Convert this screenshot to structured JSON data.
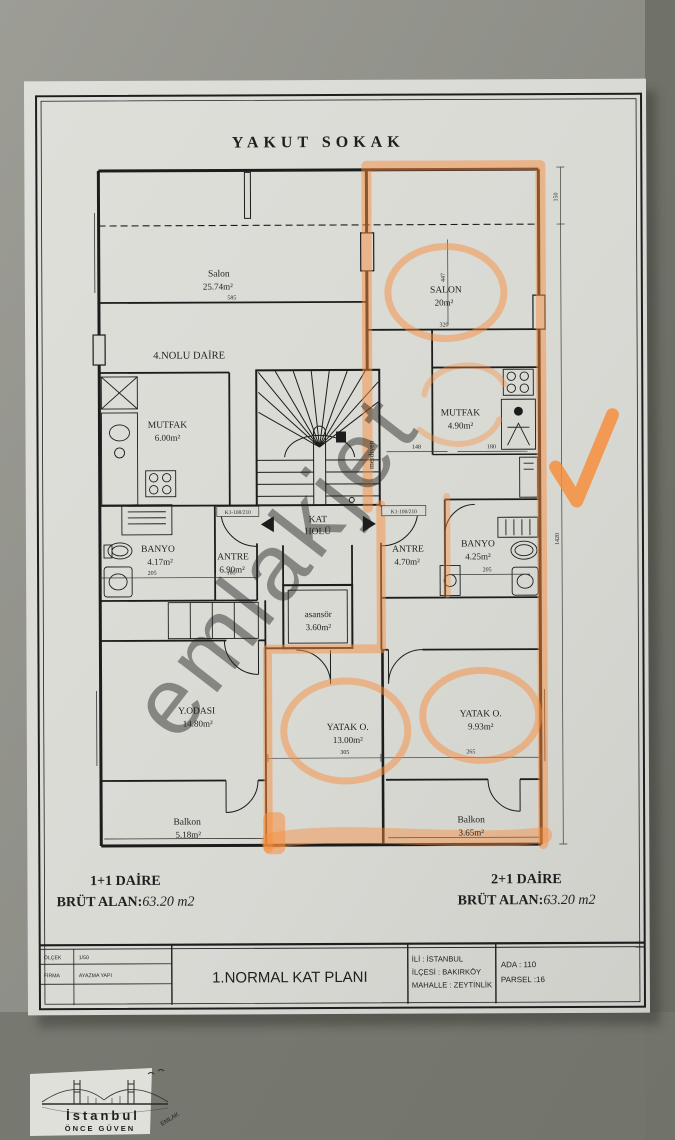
{
  "plan": {
    "street": "YAKUT SOKAK",
    "unit4_label": "4.NOLU DAİRE",
    "watermark": "emlakjet",
    "rooms": {
      "salon_left": {
        "name": "Salon",
        "area": "25.74m²"
      },
      "mutfak_left": {
        "name": "MUTFAK",
        "area": "6.00m²"
      },
      "banyo_left": {
        "name": "BANYO",
        "area": "4.17m²"
      },
      "antre_left": {
        "name": "ANTRE",
        "area": "6.90m²"
      },
      "salon_right": {
        "name": "SALON",
        "area": "20m²"
      },
      "mutfak_right": {
        "name": "MUTFAK",
        "area": "4.90m²"
      },
      "antre_right": {
        "name": "ANTRE",
        "area": "4.70m²"
      },
      "banyo_right": {
        "name": "BANYO",
        "area": "4.25m²"
      },
      "yodasi": {
        "name": "Y.ODASI",
        "area": "14.80m²"
      },
      "balkon_left": {
        "name": "Balkon",
        "area": "5.18m²"
      },
      "yatak1": {
        "name": "YATAK O.",
        "area": "13.00m²"
      },
      "yatak2": {
        "name": "YATAK O.",
        "area": "9.93m²"
      },
      "balkon_right": {
        "name": "Balkon",
        "area": "3.65m²"
      }
    },
    "core": {
      "kat1": "KAT",
      "kat2": "HOLÜ",
      "asansor_name": "asansör",
      "asansor_area": "3.60m²",
      "merdiven": "merdiven"
    },
    "doors": {
      "left": "K1-100/210",
      "right": "K1-100/210"
    },
    "dims": {
      "d585": "585",
      "d320": "320",
      "d447": "447",
      "d150": "150",
      "d1420": "1420",
      "d148": "148",
      "d180": "180",
      "d205l": "205",
      "d185": "185",
      "d205r": "205",
      "d305": "305",
      "d265": "265"
    }
  },
  "summary": {
    "left_unit": "1+1 DAİRE",
    "left_label": "BRÜT ALAN:",
    "left_value": "63.20 m2",
    "right_unit": "2+1 DAİRE",
    "right_label": "BRÜT ALAN:",
    "right_value": "63.20 m2"
  },
  "title_block": {
    "olcek_label": "ÖLÇEK",
    "olcek_value": "1/50",
    "firma_label": "FİRMA",
    "firma_value": "AYAZMA YAPI",
    "plan_title": "1.NORMAL KAT PLANI",
    "ili": "İLİ : İSTANBUL",
    "ilcesi": "İLÇESİ : BAKIRKÖY",
    "mahalle": "MAHALLE : ZEYTİNLİK",
    "ada": "ADA : 110",
    "parsel": "PARSEL :16"
  },
  "logo": {
    "city": "İstanbul",
    "tagline": "ÖNCE GÜVEN",
    "word": "EMLAK"
  },
  "colors": {
    "highlight": "#f78e3d",
    "paper": "#dadad5",
    "ink": "#1e1e1e",
    "red": "#c5312f",
    "background": "#84857d"
  }
}
